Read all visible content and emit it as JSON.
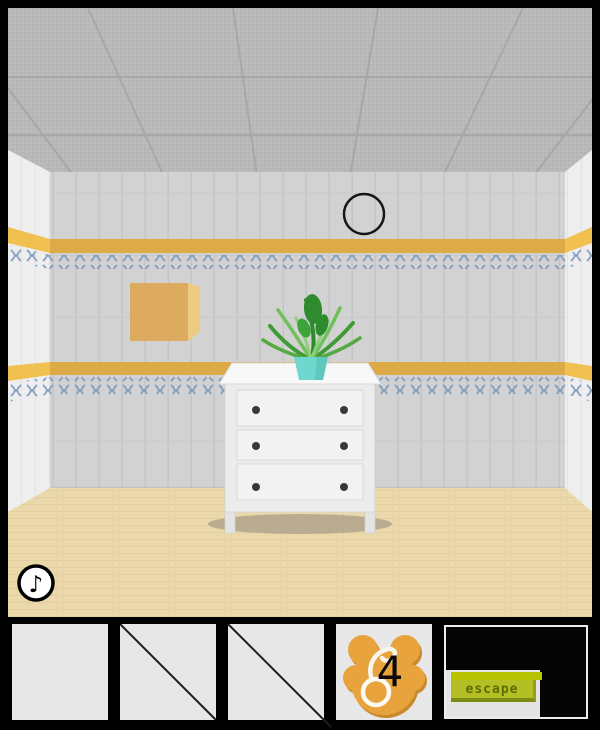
{
  "hud": {
    "music_button_glyph": "♪"
  },
  "scene": {
    "description": "tiled escape-game room with white three-drawer dresser, potted plant, black circle on wall and wooden box"
  },
  "inventory": {
    "slots": [
      {
        "id": 1,
        "state": "empty"
      },
      {
        "id": 2,
        "state": "crossed-out"
      },
      {
        "id": 3,
        "state": "crossed-out"
      },
      {
        "id": 4,
        "state": "item",
        "item": "orange-paw-medal",
        "count_label": "4"
      },
      {
        "id": 5,
        "state": "escape-panel",
        "button_label": "escape"
      }
    ]
  },
  "colors": {
    "frame": "#000000",
    "back_wall": "#d2d2d2",
    "side_wall": "#efeeee",
    "ceiling": "#b9b9b9",
    "floor": "#ecd9ab",
    "stripe_back": "#dcab48",
    "stripe_side": "#f0c050",
    "ornament_blue": "#7795bd",
    "wood_box": "#dcab5f",
    "pot_teal": "#6fd8ce",
    "dresser_white": "#efefef",
    "medal_orange": "#e8a33d",
    "escape_green": "#b3bf24",
    "slot_bg": "#e7e7e7"
  }
}
